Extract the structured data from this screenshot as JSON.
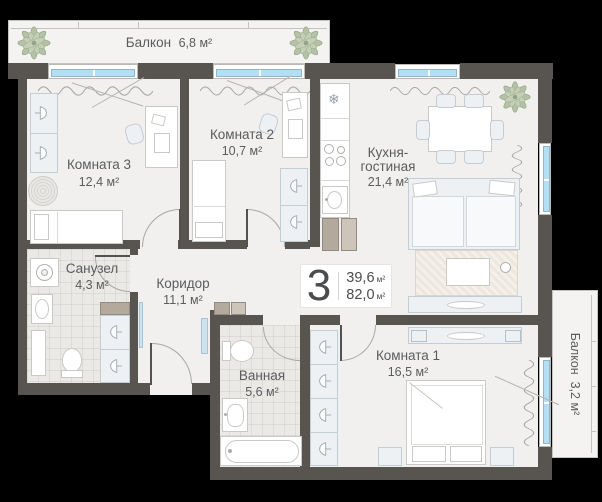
{
  "badge": {
    "number": "3",
    "area_living": "39,6",
    "area_total": "82,0",
    "unit": "м²"
  },
  "balconies": {
    "top": {
      "name": "Балкон",
      "area": "6,8 м²"
    },
    "right": {
      "name": "Балкон",
      "area": "3,2 м²"
    }
  },
  "rooms": {
    "room3": {
      "name": "Комната 3",
      "area": "12,4 м²"
    },
    "room2": {
      "name": "Комната 2",
      "area": "10,7 м²"
    },
    "kitchen": {
      "name_line1": "Кухня-",
      "name_line2": "гостиная",
      "area": "21,4 м²"
    },
    "wc": {
      "name": "Санузел",
      "area": "4,3 м²"
    },
    "corridor": {
      "name": "Коридор",
      "area": "11,1 м²"
    },
    "bathroom": {
      "name": "Ванная",
      "area": "5,6 м²"
    },
    "room1": {
      "name": "Комната 1",
      "area": "16,5 м²"
    }
  },
  "icons": {
    "fridge_snowflake": "❄"
  },
  "colors": {
    "wall": "#585550",
    "floor": "#f1f0ee",
    "window_glass": "#b5def2",
    "plant": "#b4c1a6",
    "text": "#5a5c5e",
    "background": "#000000"
  }
}
